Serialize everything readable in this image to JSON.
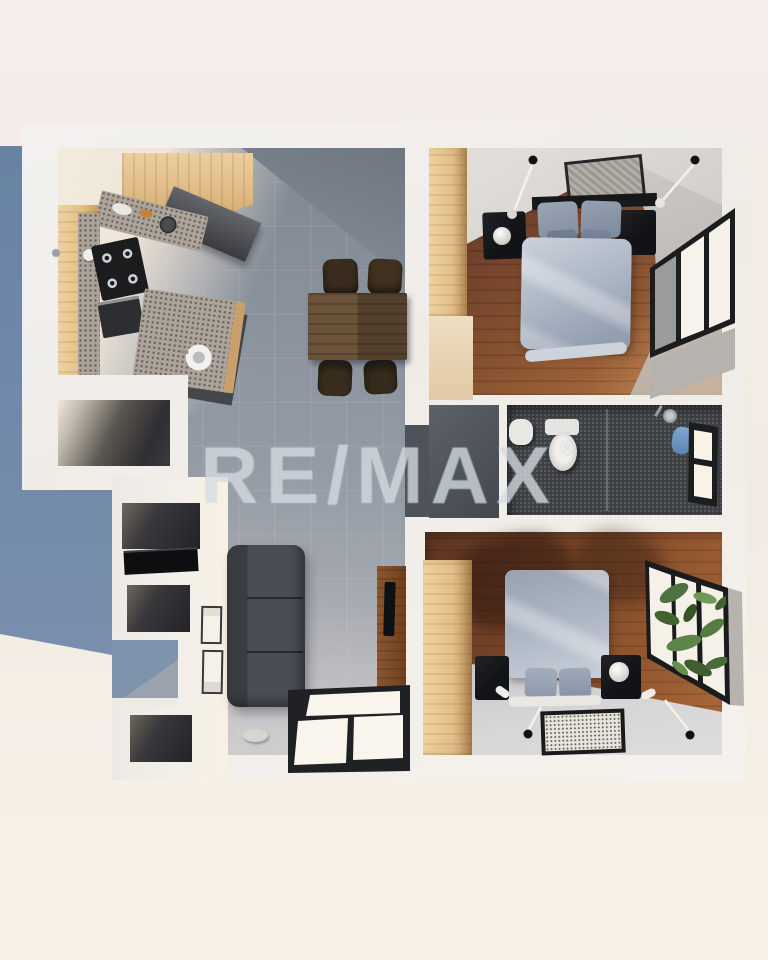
{
  "watermark": {
    "brand": "RE/MAX",
    "registered_symbol": "®",
    "color": "#d5dbe2"
  },
  "scene": {
    "description": "Top-down 3D architectural render of an apartment floor plan",
    "view": "top-down",
    "rooms": [
      {
        "name": "Kitchen",
        "contents": [
          "wood upper cabinets",
          "granite countertop",
          "gas stove with 4 burners",
          "oven",
          "island with round sink",
          "range hood"
        ]
      },
      {
        "name": "Dining area",
        "contents": [
          "rectangular wood dining table",
          "4 dark brown chairs"
        ]
      },
      {
        "name": "Living area",
        "contents": [
          "dark gray sofa",
          "wood TV console with TV",
          "floor-level black framed window",
          "small plate on floor"
        ]
      },
      {
        "name": "Utility room",
        "contents": [
          "dark floor"
        ]
      },
      {
        "name": "Hallway closets",
        "contents": [
          "black laundry counter",
          "two framed sketches on wall"
        ]
      },
      {
        "name": "Bedroom 1",
        "contents": [
          "double bed with gray-blue duvet",
          "black headboard",
          "2 black nightstands",
          "white sphere lamp",
          "wood wardrobe",
          "framed wall art",
          "2 black ceiling lamps",
          "corner window with black frame"
        ]
      },
      {
        "name": "Bathroom",
        "contents": [
          "toilet",
          "washbasin",
          "shower head",
          "blue towel",
          "small black framed window",
          "dark charcoal tile floor"
        ]
      },
      {
        "name": "Bedroom 2",
        "contents": [
          "double bed with gray-blue duvet",
          "2 black nightstands",
          "white sphere lamp",
          "wood wardrobe",
          "patterned floor mat",
          "2 black ceiling lamps",
          "black framed window with palm plants"
        ]
      }
    ]
  },
  "palette": {
    "background_cream": "#f2ebe4",
    "shadow_blue": "#6d86a8",
    "wall_white": "#efece8",
    "tile_gray": "#929aa4",
    "wood_floor": "#7c4a2e",
    "cabinet_wood": "#e2bd8c",
    "charcoal": "#3e4144",
    "bed_linen": "#aab4c2",
    "plant_green": "#55793f",
    "frame_black": "#1d1e20"
  }
}
